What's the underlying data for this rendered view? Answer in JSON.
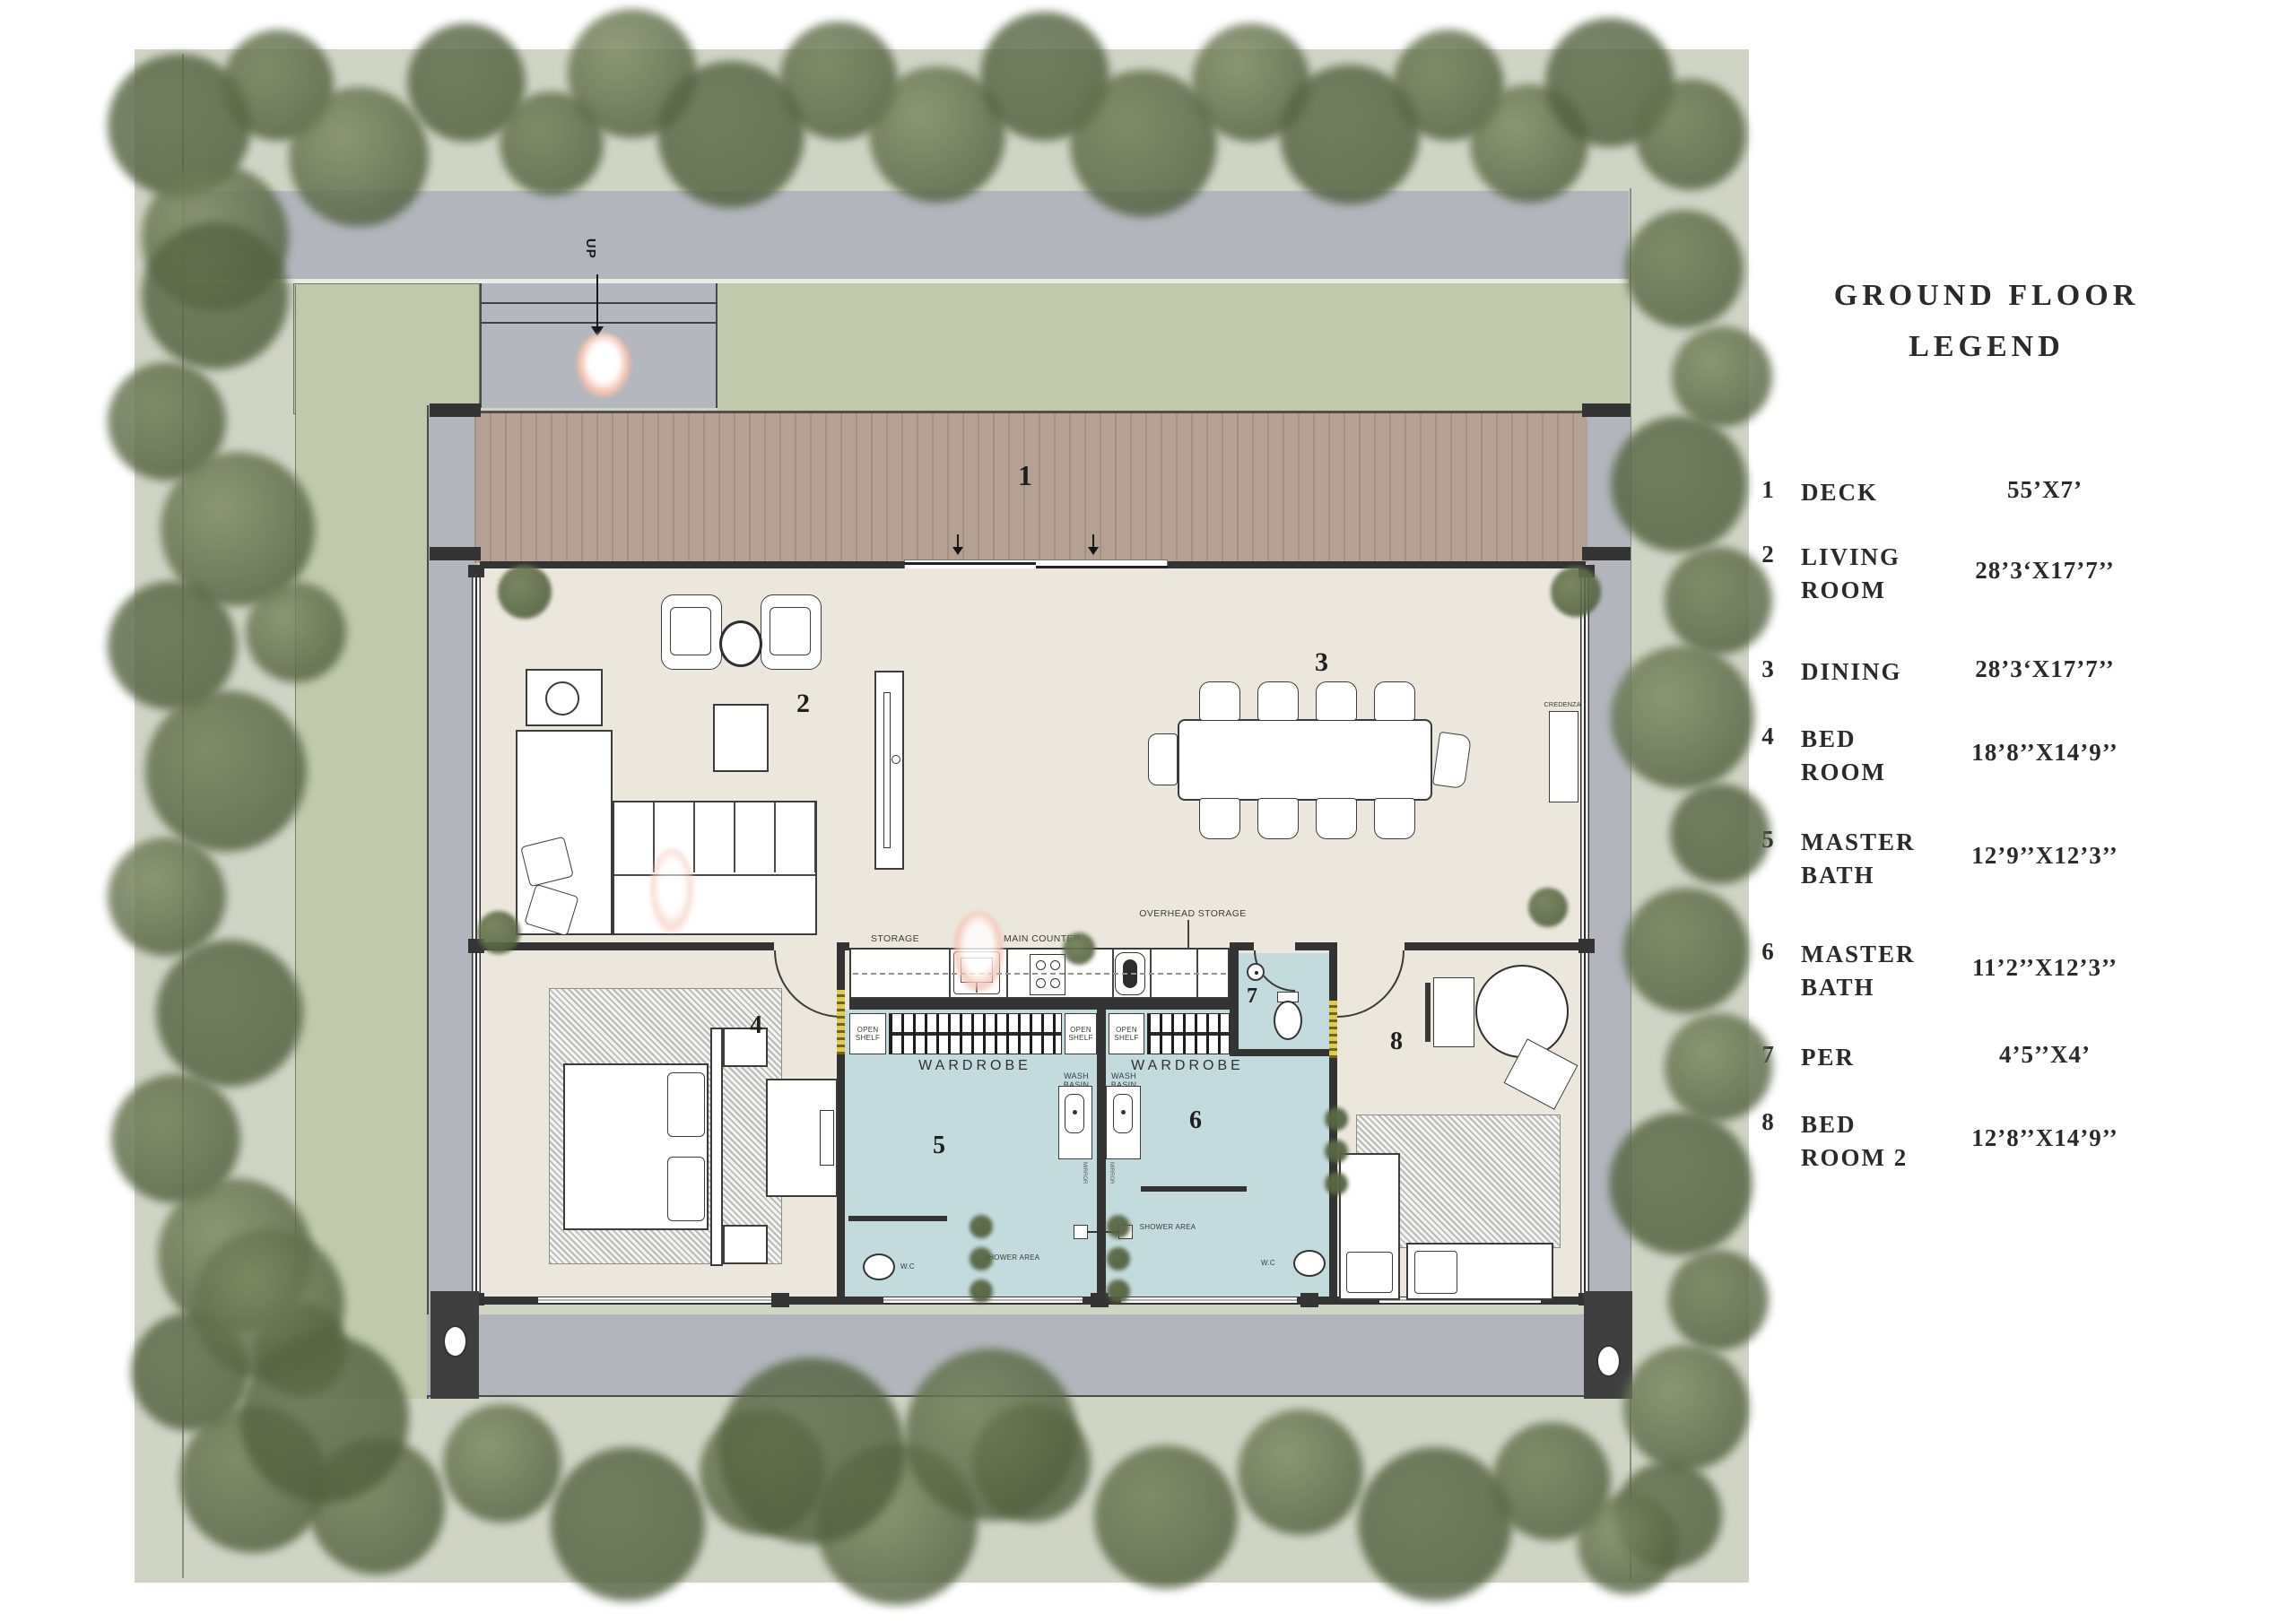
{
  "legend": {
    "title_line1": "GROUND FLOOR",
    "title_line2": "LEGEND",
    "items": [
      {
        "num": "1",
        "label_lines": [
          "DECK"
        ],
        "dims": "55’X7’"
      },
      {
        "num": "2",
        "label_lines": [
          "LIVING",
          "ROOM"
        ],
        "dims": "28’3‘X17’7’’"
      },
      {
        "num": "3",
        "label_lines": [
          "DINING"
        ],
        "dims": "28’3‘X17’7’’"
      },
      {
        "num": "4",
        "label_lines": [
          "BED",
          "ROOM"
        ],
        "dims": "18’8’’X14’9’’"
      },
      {
        "num": "5",
        "label_lines": [
          "MASTER",
          "BATH"
        ],
        "dims": "12’9’’X12’3’’"
      },
      {
        "num": "6",
        "label_lines": [
          "MASTER",
          "BATH"
        ],
        "dims": "11’2’’X12’3’’"
      },
      {
        "num": "7",
        "label_lines": [
          "PER"
        ],
        "dims": "4’5’’X4’"
      },
      {
        "num": "8",
        "label_lines": [
          "BED",
          "ROOM 2"
        ],
        "dims": "12’8’’X14’9’’"
      }
    ]
  },
  "plan": {
    "room_numbers": {
      "deck": "1",
      "living": "2",
      "dining": "3",
      "bedroom": "4",
      "master_bath_1": "5",
      "master_bath_2": "6",
      "per": "7",
      "bedroom_2": "8"
    },
    "labels": {
      "up": "UP",
      "storage": "STORAGE",
      "main_counter": "MAIN COUNTER",
      "overhead_storage": "OVERHEAD STORAGE",
      "credenza": "CREDENZA",
      "open_shelf": "OPEN SHELF",
      "wardrobe": "WARDROBE",
      "wash_basin": "WASH BASIN",
      "shower_area": "SHOWER AREA",
      "wc": "W.C",
      "mirror": "MIRROR"
    }
  },
  "colors": {
    "site_green": "#d0d4c5",
    "lawn_green": "#c0c9ac",
    "road_gray": "#b2b5bc",
    "veranda_gray": "#b2b6bc",
    "deck_wood": "#b4a193",
    "interior_cream": "#ece7dd",
    "bath_blue": "#c4dbde",
    "wall_dark": "#333333",
    "tree_green": "#66744d",
    "jamb_yellow": "#e0cb4f",
    "person_pink": "#f2bfae"
  }
}
